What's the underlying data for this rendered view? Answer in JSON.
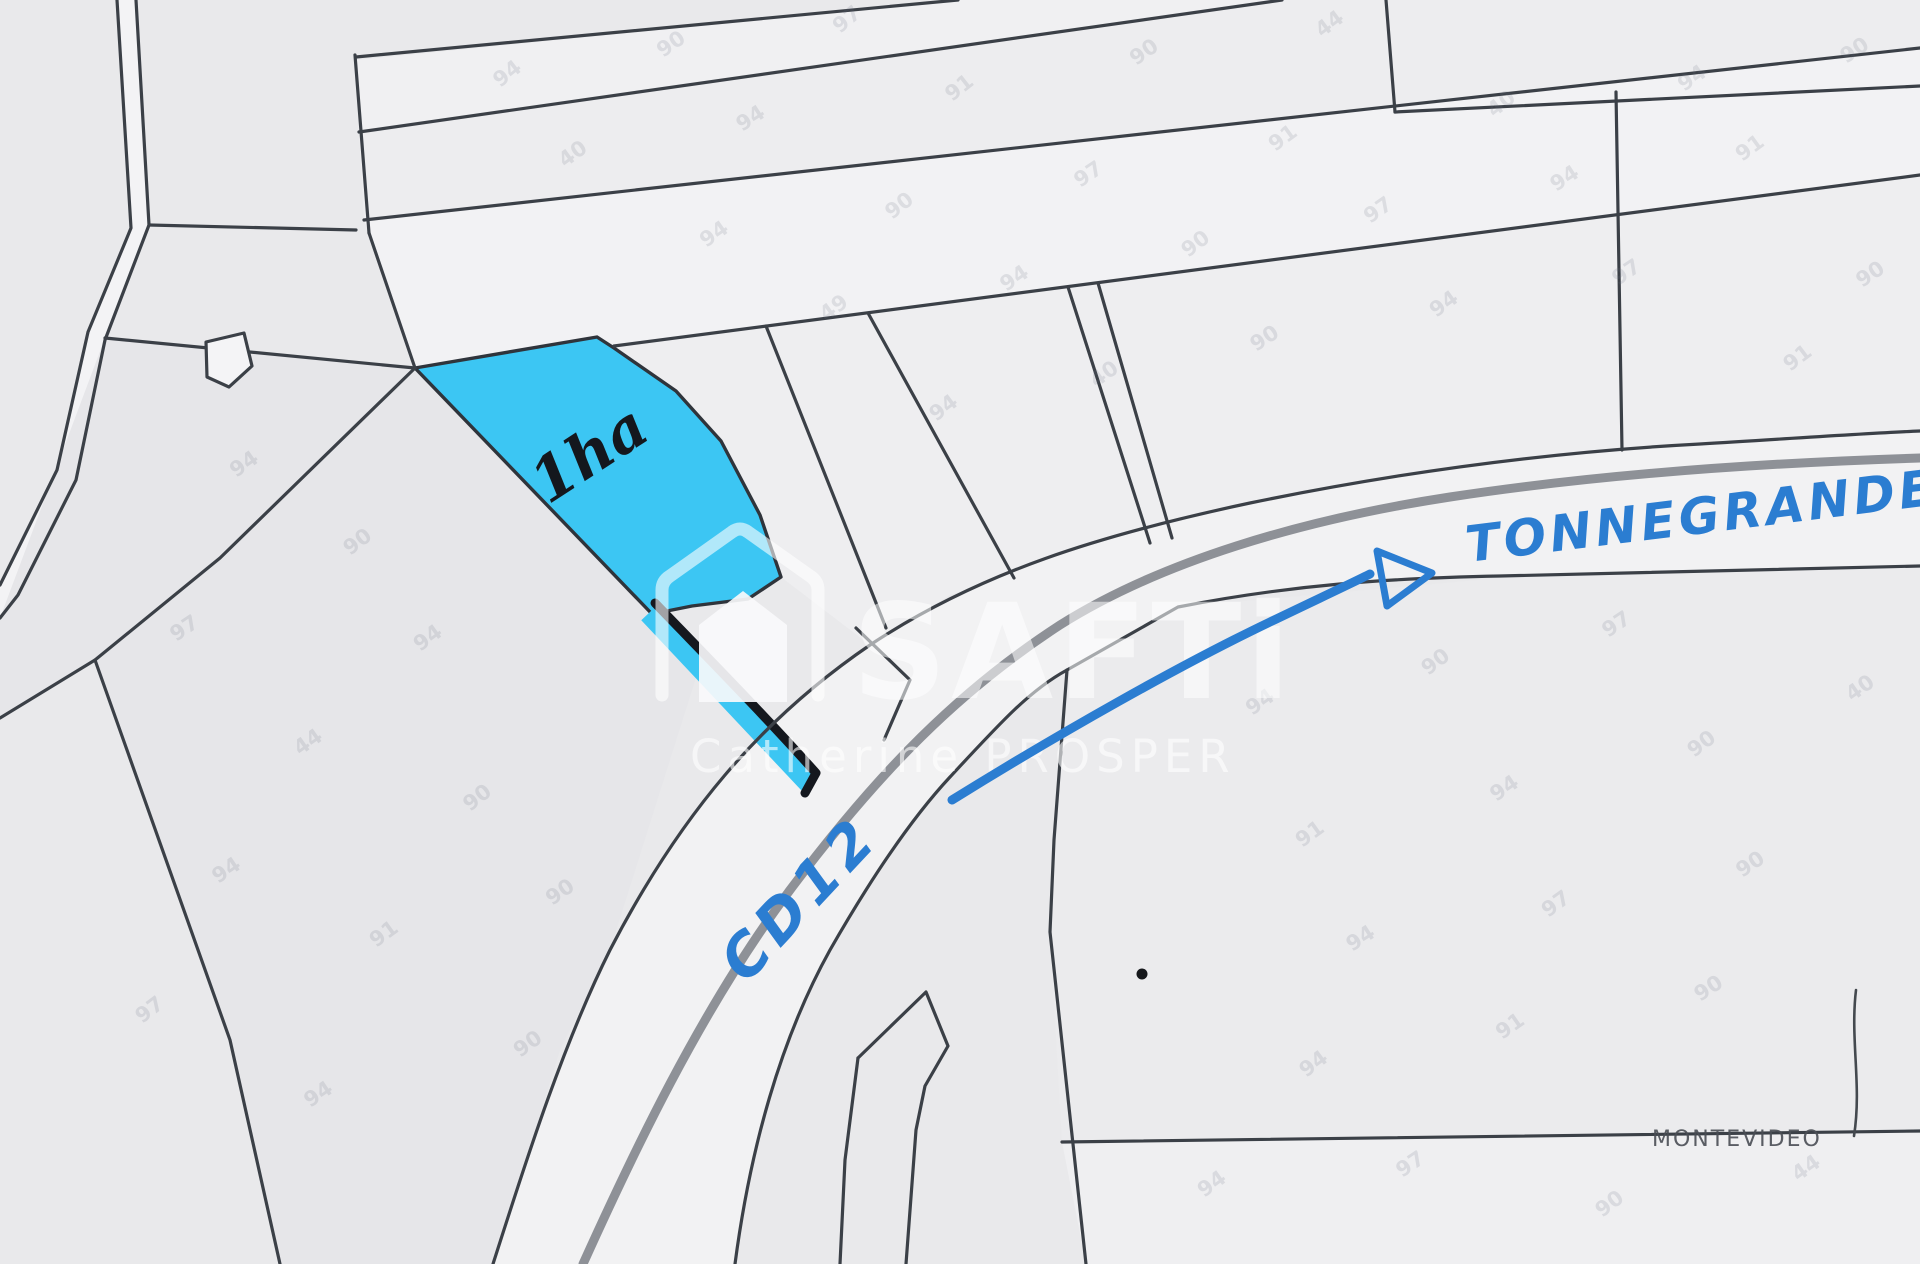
{
  "map": {
    "background_color": "#e9e9eb",
    "boundary_line_color": "#3b4047",
    "road_casing_color": "#8e9197",
    "highlighted_parcel": {
      "area_label": "1ha",
      "fill_color": "#3cc6f3",
      "ink_color": "#15181e"
    },
    "road": {
      "label": "CD12",
      "pen_color": "#2b7dd1"
    },
    "direction": {
      "label": "TONNEGRANDE",
      "arrow_icon": "right-arrow",
      "pen_color": "#2b7dd1"
    },
    "locality": {
      "label": "MONTEVIDEO"
    },
    "watermark": {
      "brand": "SAFTi",
      "agent": "Catherine PROSPER",
      "color": "#ffffff",
      "house_icon": "house-logo"
    },
    "faint_marks": [
      {
        "t": "94",
        "x": 500,
        "y": 88,
        "r": -38
      },
      {
        "t": "90",
        "x": 663,
        "y": 58,
        "r": -35
      },
      {
        "t": "97",
        "x": 840,
        "y": 34,
        "r": -40
      },
      {
        "t": "40",
        "x": 565,
        "y": 168,
        "r": -36
      },
      {
        "t": "94",
        "x": 742,
        "y": 132,
        "r": -33
      },
      {
        "t": "91",
        "x": 952,
        "y": 102,
        "r": -38
      },
      {
        "t": "90",
        "x": 1136,
        "y": 66,
        "r": -35
      },
      {
        "t": "44",
        "x": 1322,
        "y": 38,
        "r": -37
      },
      {
        "t": "94",
        "x": 706,
        "y": 248,
        "r": -35
      },
      {
        "t": "90",
        "x": 892,
        "y": 220,
        "r": -38
      },
      {
        "t": "97",
        "x": 1080,
        "y": 188,
        "r": -34
      },
      {
        "t": "91",
        "x": 1275,
        "y": 152,
        "r": -36
      },
      {
        "t": "40",
        "x": 1494,
        "y": 118,
        "r": -38
      },
      {
        "t": "94",
        "x": 1684,
        "y": 92,
        "r": -35
      },
      {
        "t": "90",
        "x": 1846,
        "y": 64,
        "r": -33
      },
      {
        "t": "49",
        "x": 826,
        "y": 322,
        "r": -36
      },
      {
        "t": "94",
        "x": 1006,
        "y": 292,
        "r": -34
      },
      {
        "t": "90",
        "x": 1188,
        "y": 258,
        "r": -37
      },
      {
        "t": "97",
        "x": 1370,
        "y": 224,
        "r": -35
      },
      {
        "t": "94",
        "x": 1556,
        "y": 192,
        "r": -33
      },
      {
        "t": "91",
        "x": 1742,
        "y": 162,
        "r": -36
      },
      {
        "t": "90",
        "x": 1862,
        "y": 288,
        "r": -34
      },
      {
        "t": "94",
        "x": 936,
        "y": 422,
        "r": -37
      },
      {
        "t": "40",
        "x": 1096,
        "y": 388,
        "r": -35
      },
      {
        "t": "90",
        "x": 1256,
        "y": 352,
        "r": -33
      },
      {
        "t": "94",
        "x": 1436,
        "y": 318,
        "r": -36
      },
      {
        "t": "97",
        "x": 1618,
        "y": 286,
        "r": -34
      },
      {
        "t": "91",
        "x": 1790,
        "y": 372,
        "r": -37
      },
      {
        "t": "94",
        "x": 236,
        "y": 478,
        "r": -35
      },
      {
        "t": "90",
        "x": 350,
        "y": 556,
        "r": -37
      },
      {
        "t": "97",
        "x": 176,
        "y": 642,
        "r": -34
      },
      {
        "t": "94",
        "x": 420,
        "y": 652,
        "r": -36
      },
      {
        "t": "44",
        "x": 300,
        "y": 756,
        "r": -35
      },
      {
        "t": "90",
        "x": 470,
        "y": 812,
        "r": -38
      },
      {
        "t": "94",
        "x": 218,
        "y": 884,
        "r": -34
      },
      {
        "t": "91",
        "x": 376,
        "y": 948,
        "r": -36
      },
      {
        "t": "90",
        "x": 552,
        "y": 906,
        "r": -35
      },
      {
        "t": "97",
        "x": 142,
        "y": 1024,
        "r": -37
      },
      {
        "t": "94",
        "x": 310,
        "y": 1108,
        "r": -34
      },
      {
        "t": "90",
        "x": 520,
        "y": 1058,
        "r": -36
      },
      {
        "t": "94",
        "x": 1252,
        "y": 716,
        "r": -35
      },
      {
        "t": "90",
        "x": 1428,
        "y": 676,
        "r": -37
      },
      {
        "t": "97",
        "x": 1608,
        "y": 638,
        "r": -34
      },
      {
        "t": "91",
        "x": 1302,
        "y": 848,
        "r": -36
      },
      {
        "t": "94",
        "x": 1496,
        "y": 802,
        "r": -34
      },
      {
        "t": "90",
        "x": 1694,
        "y": 758,
        "r": -37
      },
      {
        "t": "40",
        "x": 1852,
        "y": 702,
        "r": -35
      },
      {
        "t": "94",
        "x": 1352,
        "y": 952,
        "r": -33
      },
      {
        "t": "97",
        "x": 1548,
        "y": 918,
        "r": -36
      },
      {
        "t": "90",
        "x": 1742,
        "y": 878,
        "r": -34
      },
      {
        "t": "94",
        "x": 1306,
        "y": 1078,
        "r": -37
      },
      {
        "t": "91",
        "x": 1502,
        "y": 1040,
        "r": -35
      },
      {
        "t": "90",
        "x": 1700,
        "y": 1002,
        "r": -33
      },
      {
        "t": "94",
        "x": 1204,
        "y": 1198,
        "r": -36
      },
      {
        "t": "97",
        "x": 1402,
        "y": 1178,
        "r": -34
      },
      {
        "t": "90",
        "x": 1602,
        "y": 1218,
        "r": -37
      },
      {
        "t": "44",
        "x": 1798,
        "y": 1182,
        "r": -35
      }
    ]
  }
}
